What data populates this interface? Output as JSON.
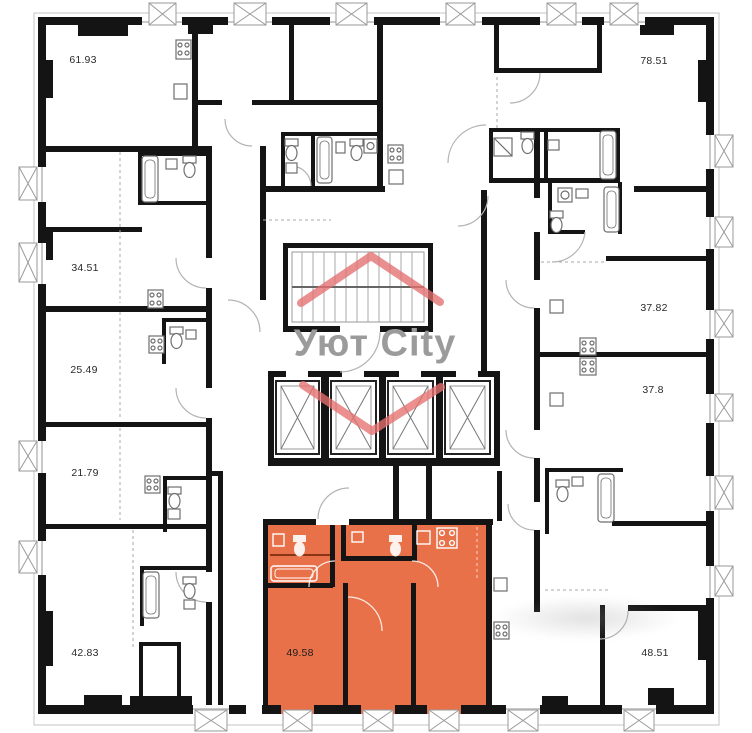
{
  "page": {
    "background": "#ffffff"
  },
  "logo": {
    "text": "Уют City",
    "text_color": "#9b9b9b",
    "house_icon_color": "#e57070"
  },
  "plan": {
    "wall_color": "#141414",
    "highlight_color": "#e8714a",
    "elevator_count": 4,
    "has_staircase": true
  },
  "apartments": [
    {
      "area": "61.93",
      "highlighted": false
    },
    {
      "area": "34.51",
      "highlighted": false
    },
    {
      "area": "25.49",
      "highlighted": false
    },
    {
      "area": "21.79",
      "highlighted": false
    },
    {
      "area": "42.83",
      "highlighted": false
    },
    {
      "area": "78.51",
      "highlighted": false
    },
    {
      "area": "37.82",
      "highlighted": false
    },
    {
      "area": "37.8",
      "highlighted": false
    },
    {
      "area": "48.51",
      "highlighted": false
    },
    {
      "area": "49.58",
      "highlighted": true
    }
  ]
}
